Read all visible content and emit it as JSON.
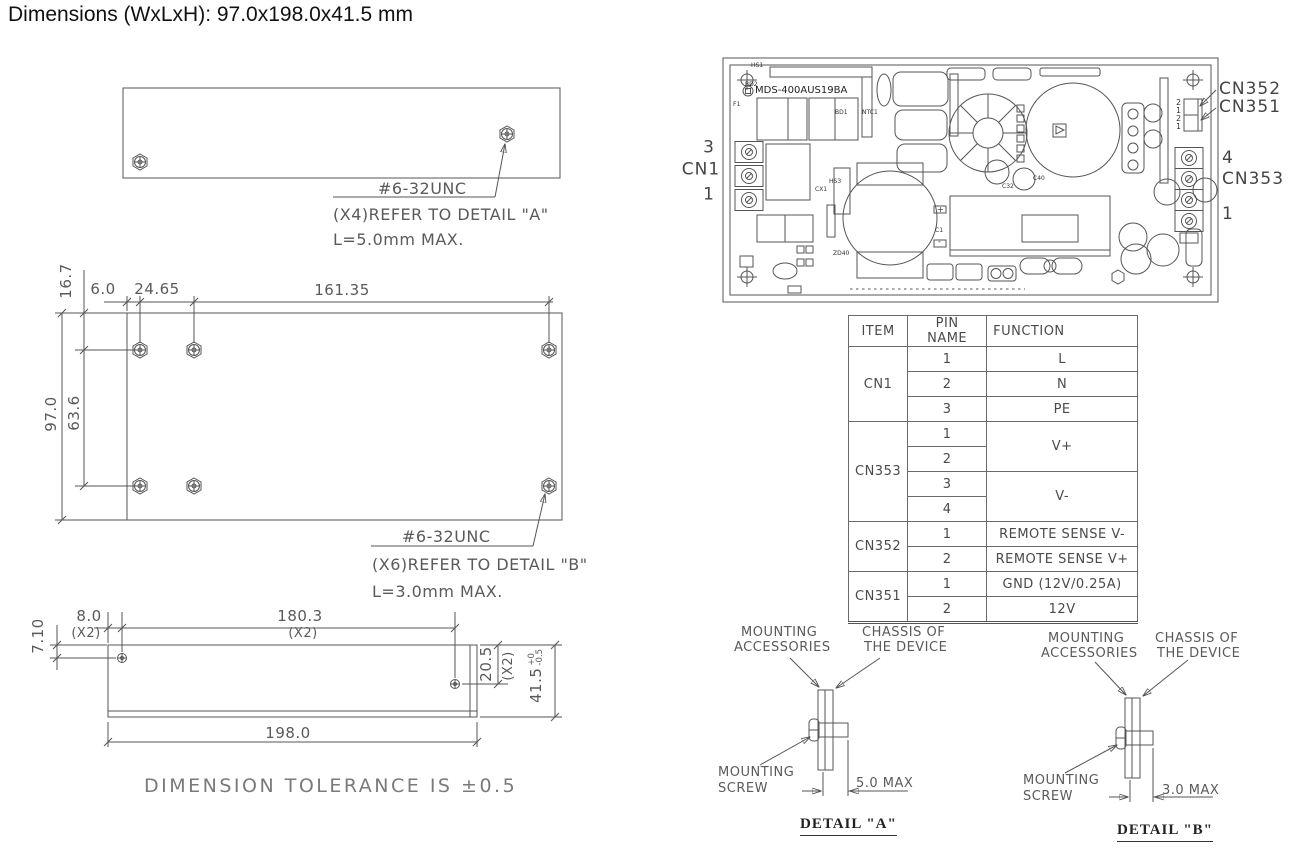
{
  "title": "Dimensions (WxLxH): 97.0x198.0x41.5 mm",
  "tolerance_note": "DIMENSION TOLERANCE IS ±0.5",
  "top_view": {
    "thread": "#6-32UNC",
    "refer": "(X4)REFER TO DETAIL \"A\"",
    "max_len": "L=5.0mm MAX."
  },
  "plan_view": {
    "thread": "#6-32UNC",
    "refer": "(X6)REFER TO DETAIL \"B\"",
    "max_len": "L=3.0mm MAX.",
    "dims": {
      "hole_top_offset": "16.7",
      "hole_left_offset": "6.0",
      "hole_gap": "24.65",
      "hole_span": "161.35",
      "body_width": "97.0",
      "hole_row_gap": "63.6"
    }
  },
  "side_view": {
    "dims": {
      "screw_top_offset": "7.10",
      "screw_left_offset": "8.0",
      "qty_a": "(X2)",
      "screw_span": "180.3",
      "qty_b": "(X2)",
      "screw_height_offset": "20.5",
      "qty_c": "(X2)",
      "body_height": "41.5",
      "tol_plus": "+0",
      "tol_minus": "-0.5",
      "body_length": "198.0"
    }
  },
  "pcb": {
    "silkscreen": "MDS-400AUS19BA",
    "cn1": {
      "pin_top": "3",
      "name": "CN1",
      "pin_bottom": "1"
    },
    "cn353": {
      "pin_top": "4",
      "name": "CN353",
      "pin_bottom": "1"
    },
    "cn352_label": "CN352",
    "cn351_label": "CN351",
    "header_pins": [
      "2",
      "1",
      "2",
      "1"
    ],
    "labels": {
      "hs1": "HS1",
      "bd2": "BD2",
      "f1": "F1",
      "bd1": "BD1",
      "ntc1": "NTC1",
      "hs3": "HS3",
      "cx1": "CX1",
      "zd40": "ZD40",
      "c1": "C1",
      "c32": "C32",
      "c40": "C40",
      "plus": "+",
      "minus": "-"
    }
  },
  "pin_table": {
    "headers": [
      "ITEM",
      "PIN NAME",
      "FUNCTION"
    ],
    "items": [
      "CN1",
      "CN353",
      "CN352",
      "CN351"
    ],
    "pins": [
      "1",
      "2",
      "3",
      "1",
      "2",
      "3",
      "4",
      "1",
      "2",
      "1",
      "2"
    ],
    "functions": [
      "L",
      "N",
      "PE",
      "V+",
      "V-",
      "REMOTE SENSE V-",
      "REMOTE SENSE V+",
      "GND (12V/0.25A)",
      "12V"
    ]
  },
  "details": [
    {
      "acc1": "MOUNTING",
      "acc2": "ACCESSORIES",
      "chassis1": "CHASSIS OF",
      "chassis2": "THE DEVICE",
      "screw1": "MOUNTING",
      "screw2": "SCREW",
      "max": "5.0 MAX",
      "caption": "DETAIL \"A\""
    },
    {
      "acc1": "MOUNTING",
      "acc2": "ACCESSORIES",
      "chassis1": "CHASSIS OF",
      "chassis2": "THE DEVICE",
      "screw1": "MOUNTING",
      "screw2": "SCREW",
      "max": "3.0 MAX",
      "caption": "DETAIL \"B\""
    }
  ]
}
